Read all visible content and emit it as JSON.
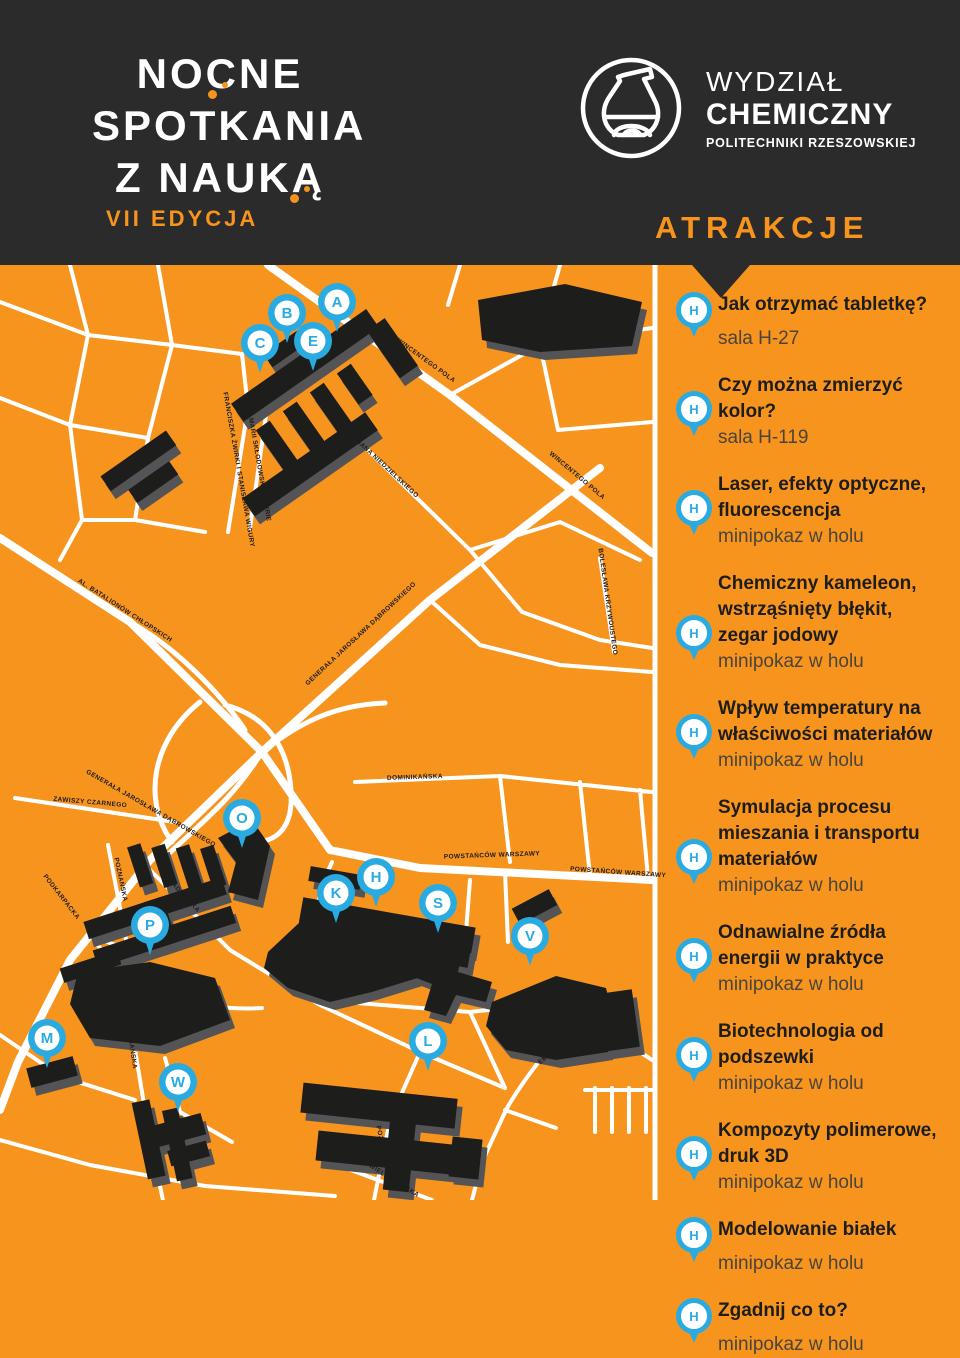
{
  "colors": {
    "background_orange": "#F7941E",
    "header_dark": "#2B2B2B",
    "marker_blue": "#29ABE2",
    "building_black": "#1D1D1B",
    "building_shadow_gray": "#545456",
    "road_white": "#FFFFFF"
  },
  "header": {
    "event": {
      "line1": "NOCNE",
      "line2": "SPOTKANIA",
      "line3": "Z NAUKĄ",
      "edition": "VII EDYCJA"
    },
    "faculty": {
      "line1": "WYDZIAŁ",
      "line2": "CHEMICZNY",
      "line3": "POLITECHNIKI RZESZOWSKIEJ",
      "logo": "flask-icon"
    },
    "section_title": "ATRAKCJE"
  },
  "attractions": [
    {
      "marker": "H",
      "title": "Jak otrzymać tabletkę?",
      "location": "sala H-27"
    },
    {
      "marker": "H",
      "title": "Czy można zmierzyć kolor?",
      "location": "sala H-119"
    },
    {
      "marker": "H",
      "title": "Laser, efekty optyczne, fluorescencja",
      "location": "minipokaz w holu"
    },
    {
      "marker": "H",
      "title": "Chemiczny kameleon, wstrząśnięty błękit, zegar jodowy",
      "location": "minipokaz w holu"
    },
    {
      "marker": "H",
      "title": "Wpływ temperatury na właściwości materiałów",
      "location": "minipokaz w holu"
    },
    {
      "marker": "H",
      "title": "Symulacja procesu mieszania i transportu materiałów",
      "location": "minipokaz w holu"
    },
    {
      "marker": "H",
      "title": "Odnawialne źródła energii w praktyce",
      "location": "minipokaz w holu"
    },
    {
      "marker": "H",
      "title": "Biotechnologia od podszewki",
      "location": "minipokaz w holu"
    },
    {
      "marker": "H",
      "title": "Kompozyty polimerowe, druk 3D",
      "location": "minipokaz w holu"
    },
    {
      "marker": "H",
      "title": "Modelowanie białek",
      "location": "minipokaz w holu"
    },
    {
      "marker": "H",
      "title": "Zgadnij co to?",
      "location": "minipokaz w holu"
    }
  ],
  "map": {
    "pins": [
      {
        "label": "A",
        "x": 337,
        "y": 302
      },
      {
        "label": "B",
        "x": 287,
        "y": 313
      },
      {
        "label": "C",
        "x": 260,
        "y": 343
      },
      {
        "label": "E",
        "x": 313,
        "y": 341
      },
      {
        "label": "O",
        "x": 242,
        "y": 818
      },
      {
        "label": "P",
        "x": 150,
        "y": 925
      },
      {
        "label": "M",
        "x": 47,
        "y": 1038
      },
      {
        "label": "W",
        "x": 178,
        "y": 1082
      },
      {
        "label": "K",
        "x": 336,
        "y": 893
      },
      {
        "label": "H",
        "x": 376,
        "y": 877
      },
      {
        "label": "S",
        "x": 438,
        "y": 903
      },
      {
        "label": "V",
        "x": 530,
        "y": 936
      },
      {
        "label": "L",
        "x": 428,
        "y": 1041
      }
    ],
    "street_labels": [
      {
        "text": "WINCENTEGO POLA",
        "x": 425,
        "y": 362,
        "angle": 36
      },
      {
        "text": "WINCENTEGO POLA",
        "x": 576,
        "y": 477,
        "angle": 40
      },
      {
        "text": "ROMANA NIEDZIELSKIEGO",
        "x": 382,
        "y": 466,
        "angle": 43
      },
      {
        "text": "FRANCISZKA ŻWIRKI I STANISŁAWA WIGURY",
        "x": 237,
        "y": 470,
        "angle": 80
      },
      {
        "text": "MARII SKŁODOWSKIEJ-CURIE",
        "x": 258,
        "y": 470,
        "angle": 80
      },
      {
        "text": "BOLESŁAWA KRZYWOUSTEGO",
        "x": 606,
        "y": 602,
        "angle": 82
      },
      {
        "text": "GENERAŁA JAROSŁAWA DĄBROWSKIEGO",
        "x": 362,
        "y": 635,
        "angle": -43
      },
      {
        "text": "AL. BATALIONÓW CHŁOPSKICH",
        "x": 124,
        "y": 612,
        "angle": 33
      },
      {
        "text": "GENERAŁA JAROSŁAWA DĄBROWSKIEGO",
        "x": 150,
        "y": 810,
        "angle": 30
      },
      {
        "text": "ZAWISZY CZARNEGO",
        "x": 90,
        "y": 804,
        "angle": 5
      },
      {
        "text": "DOMINIKAŃSKA",
        "x": 415,
        "y": 779,
        "angle": -2
      },
      {
        "text": "POWSTAŃCÓW WARSZAWY",
        "x": 492,
        "y": 857,
        "angle": -2
      },
      {
        "text": "POWSTAŃCÓW WARSZAWY",
        "x": 618,
        "y": 874,
        "angle": 4
      },
      {
        "text": "PODKARPACKA",
        "x": 60,
        "y": 898,
        "angle": 52
      },
      {
        "text": "POZNAŃSKA",
        "x": 119,
        "y": 880,
        "angle": 78
      },
      {
        "text": "AKADEMICKA",
        "x": 181,
        "y": 895,
        "angle": 47
      },
      {
        "text": "POZNAŃSKA",
        "x": 130,
        "y": 1047,
        "angle": 82
      },
      {
        "text": "EMILII PLATER",
        "x": 560,
        "y": 1048,
        "angle": -40
      },
      {
        "text": "POZNAŃSKA",
        "x": 381,
        "y": 1148,
        "angle": 78
      },
      {
        "text": "WIELKOPOLSKA",
        "x": 393,
        "y": 1182,
        "angle": 32
      }
    ]
  }
}
